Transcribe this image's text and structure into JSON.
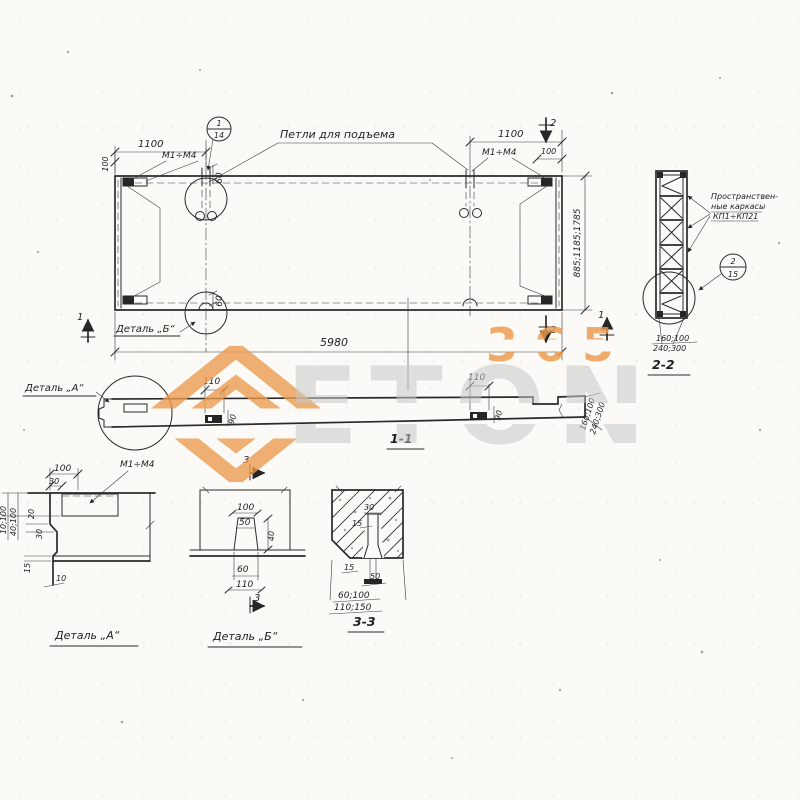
{
  "meta": {
    "paper_color": "#fbfaf7",
    "ink_color": "#2a2a2a",
    "accent_orange": "#ee9a4d",
    "watermark_gray": "#c8c8c6"
  },
  "plan": {
    "dim_1100_left": "1100",
    "dim_100_left": "100",
    "callout_num": "1",
    "callout_sheet": "14",
    "loops_label": "Петли для подъема",
    "marks_left": "М1÷М4",
    "marks_right": "М1÷М4",
    "dim_1100_right": "1100",
    "dim_100_right": "100",
    "dim_60_top": "60",
    "dim_60_bottom": "60",
    "dim_right_heights": "885;1185;1785",
    "dim_length": "5980",
    "detail_b_ref": "Деталь „Б“",
    "cut1_left": "1",
    "cut1_right": "1",
    "cut2_top": "2",
    "cut2_bottom": "2"
  },
  "section11": {
    "title": "1-1",
    "detail_a_ref": "Деталь „А“",
    "dim_110_left": "110",
    "dim_90_left": "90",
    "dim_110_right": "110",
    "dim_90_right": "90",
    "dim_end_a": "160;100",
    "dim_end_b": "240;300"
  },
  "section22": {
    "title": "2-2",
    "note_line1": "Пространствен-",
    "note_line2": "ные каркасы",
    "note_line3": "КП1÷КП21",
    "callout_num": "2",
    "callout_sheet": "15",
    "dim_a": "160;100",
    "dim_b": "240;300"
  },
  "detail_a": {
    "title": "Деталь „А“",
    "marks": "М1÷М4",
    "dim_100": "100",
    "dim_30_top": "30",
    "dim_left_a": "10;100",
    "dim_left_b": "40;100",
    "dim_20": "20",
    "dim_30_mid": "30",
    "dim_15": "15",
    "dim_10": "10"
  },
  "detail_b": {
    "title": "Деталь „Б“",
    "cut3_top": "3",
    "cut3_bottom": "3",
    "dim_100": "100",
    "dim_50": "50",
    "dim_40": "40",
    "dim_60": "60",
    "dim_110": "110"
  },
  "section33": {
    "title": "3-3",
    "dim_30": "30",
    "dim_15_top": "15",
    "dim_15_bottom": "15",
    "dim_50": "50",
    "dim_a": "60;100",
    "dim_b": "110;150"
  },
  "watermark": {
    "digits": "365",
    "brand": "ETON"
  }
}
